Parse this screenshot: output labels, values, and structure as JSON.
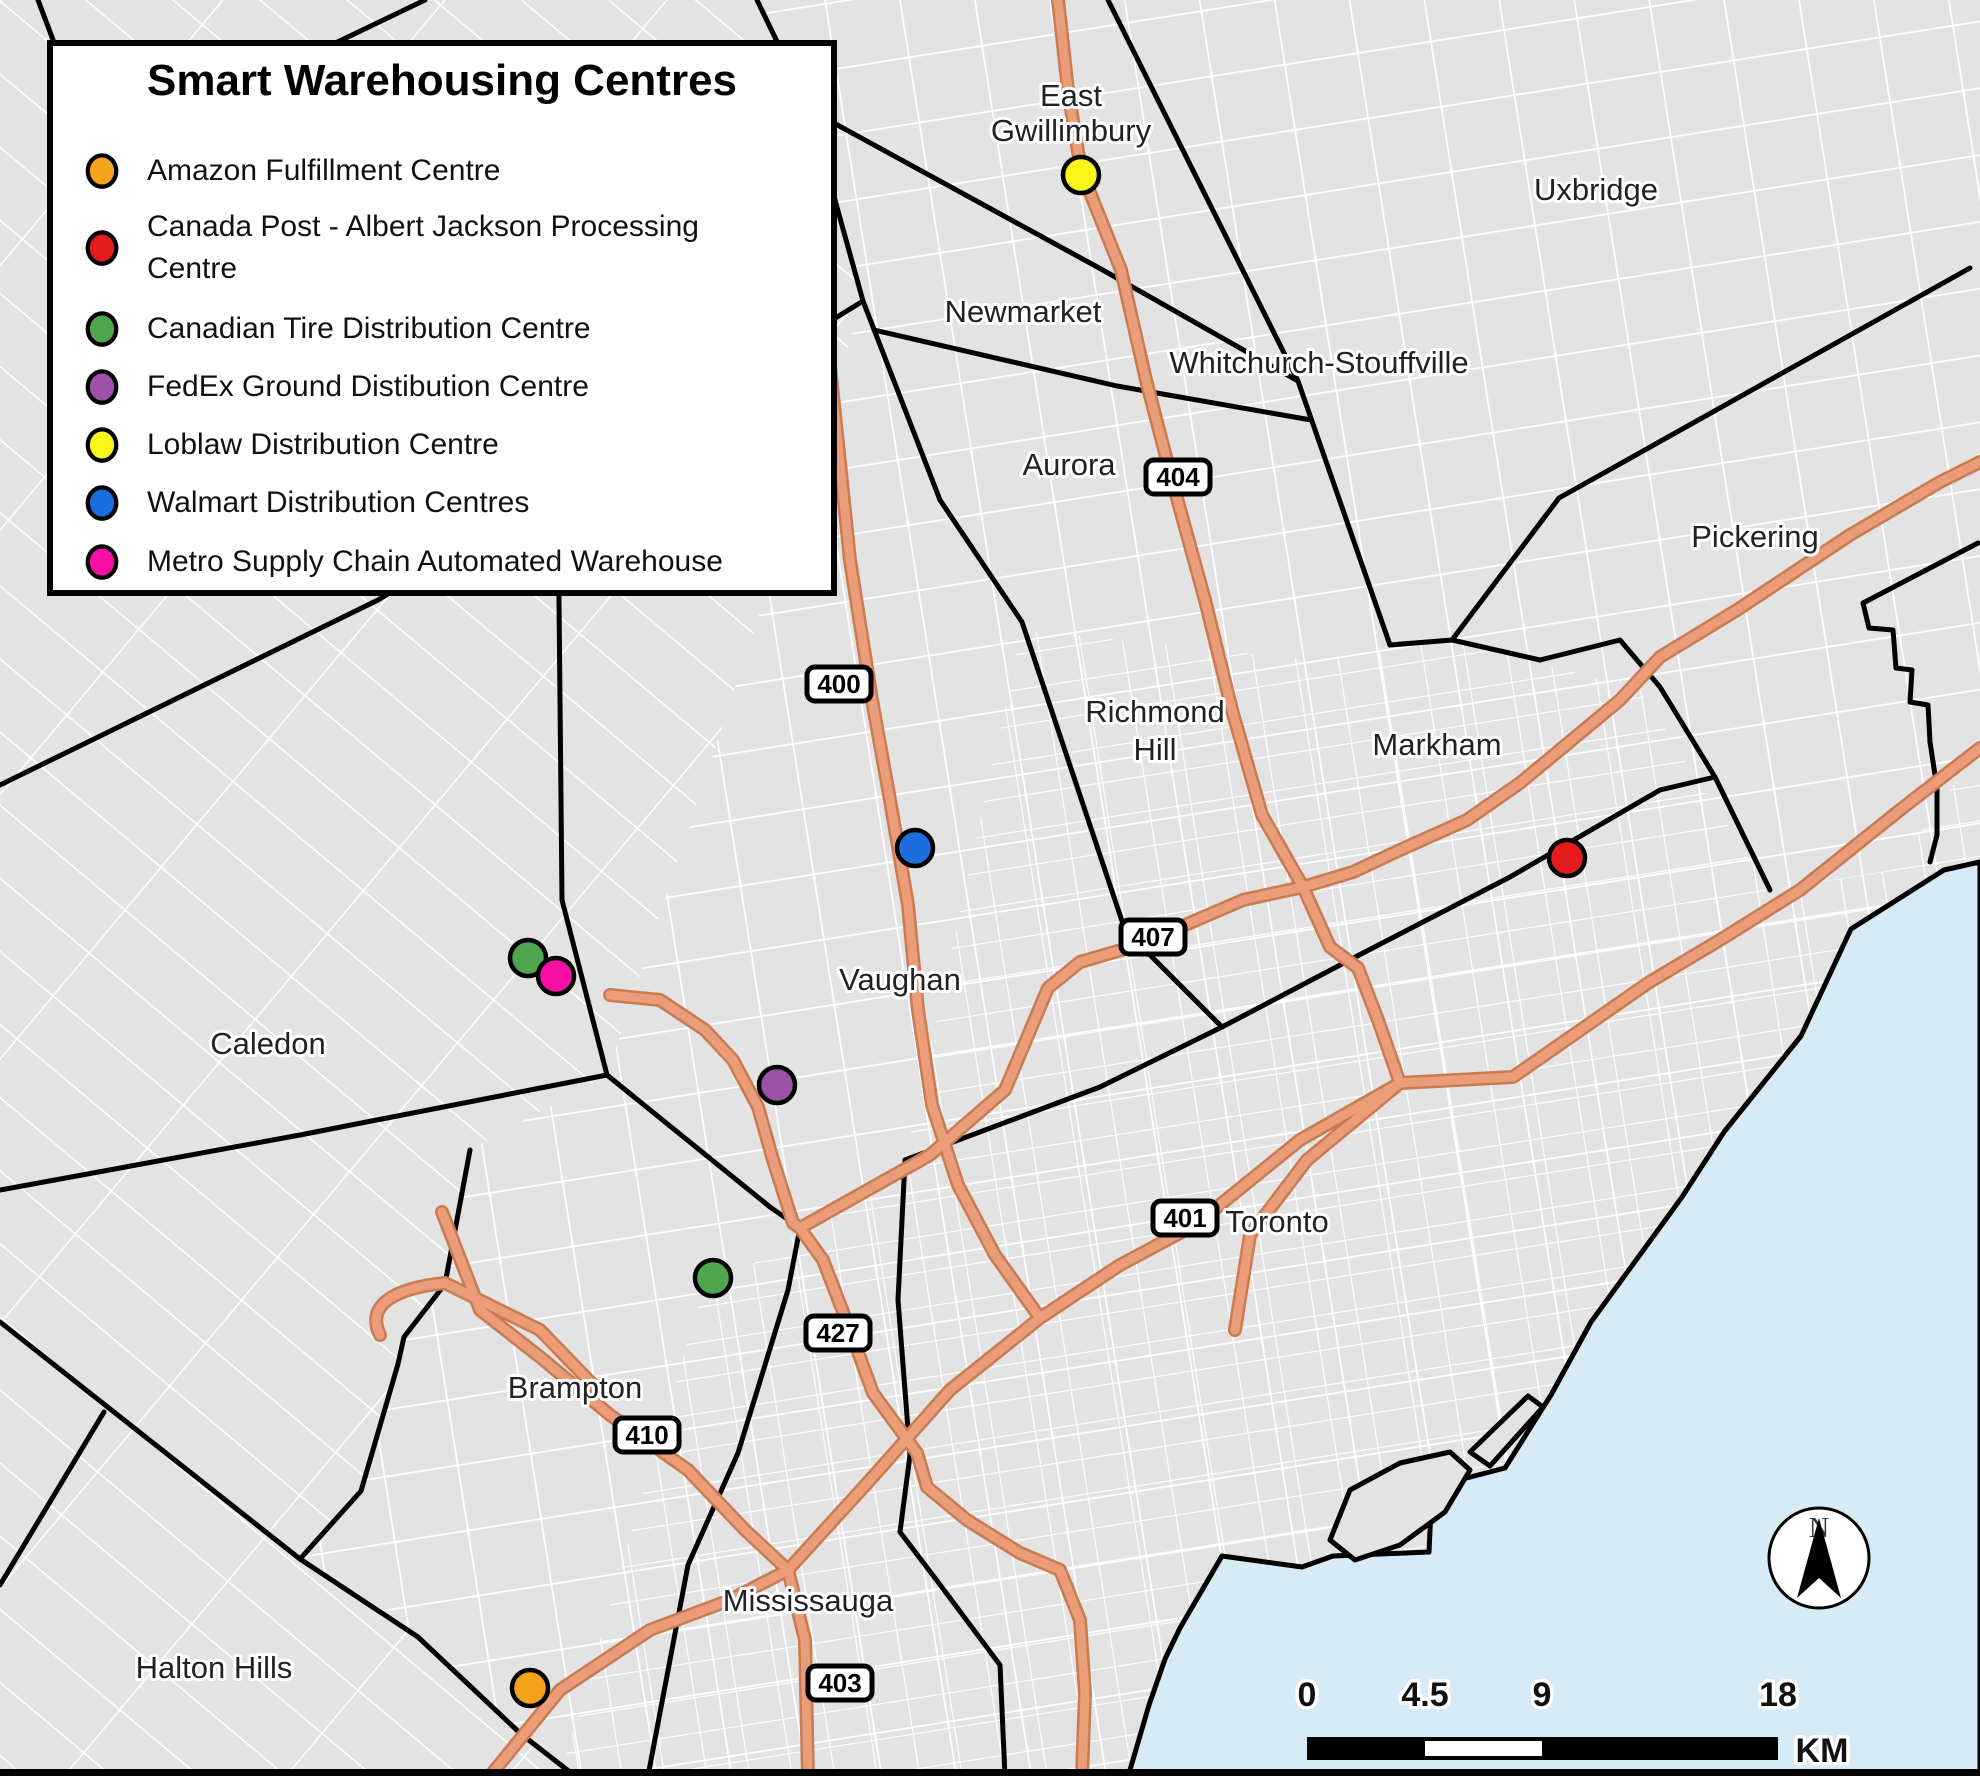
{
  "legend": {
    "title": "Smart Warehousing Centres",
    "items": [
      {
        "label": "Amazon Fulfillment Centre",
        "color": "#F5A31B"
      },
      {
        "label": "Canada Post - Albert Jackson Processing",
        "label2": "Centre",
        "color": "#E21B1C"
      },
      {
        "label": "Canadian Tire Distribution Centre",
        "color": "#4FA64F"
      },
      {
        "label": "FedEx Ground Distibution Centre",
        "color": "#9B51A5"
      },
      {
        "label": "Loblaw Distribution Centre",
        "color": "#F8F41C"
      },
      {
        "label": "Walmart Distribution Centres",
        "color": "#1A6FDC"
      },
      {
        "label": "Metro Supply Chain Automated Warehouse",
        "color": "#F50FA5"
      }
    ]
  },
  "map": {
    "cities": [
      {
        "label": "East",
        "label2": "Gwillimbury"
      },
      {
        "label": "Newmarket"
      },
      {
        "label": "Whitchurch-Stouffville"
      },
      {
        "label": "Uxbridge"
      },
      {
        "label": "Aurora"
      },
      {
        "label": "Pickering"
      },
      {
        "label": "Richmond",
        "label2": "Hill"
      },
      {
        "label": "Markham"
      },
      {
        "label": "Vaughan"
      },
      {
        "label": "Caledon"
      },
      {
        "label": "Brampton"
      },
      {
        "label": "Halton Hills"
      },
      {
        "label": "Mississauga"
      },
      {
        "label": "Toronto"
      }
    ],
    "highway_shields": [
      {
        "number": "400"
      },
      {
        "number": "404"
      },
      {
        "number": "407"
      },
      {
        "number": "401"
      },
      {
        "number": "427"
      },
      {
        "number": "410"
      },
      {
        "number": "403"
      }
    ],
    "colors": {
      "land": "#E3E3E3",
      "street": "#FFFFFF",
      "water": "#D6EBF5",
      "boundary": "#000000",
      "highway": "#EB9C78",
      "highway_casing": "#C97B52"
    }
  },
  "scale_bar": {
    "ticks": [
      "0",
      "4.5",
      "9",
      "18"
    ],
    "unit": "KM"
  },
  "north_arrow": {
    "label": "N"
  }
}
